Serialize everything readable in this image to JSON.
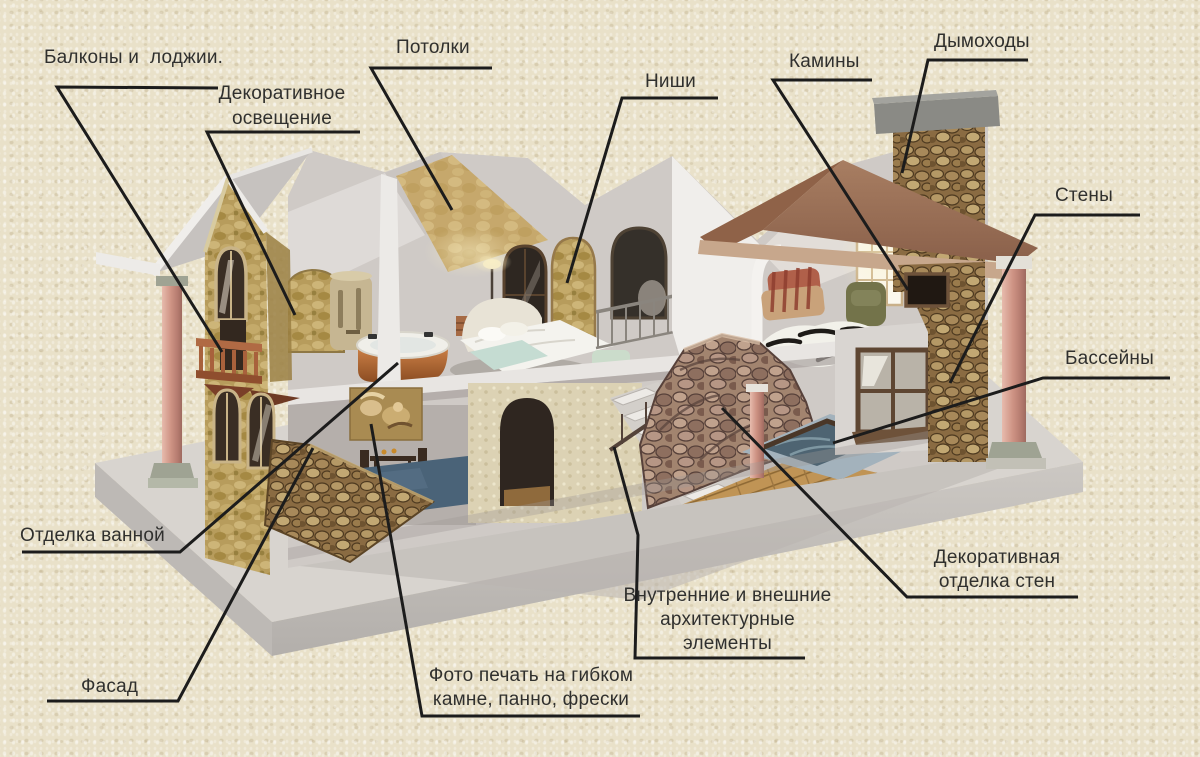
{
  "diagram": {
    "type": "labeled-cutaway-house",
    "language": "ru",
    "subject": "house-finishing-services",
    "labels": {
      "balconies": {
        "text": "Балконы и  лоджии."
      },
      "decorative_lighting": {
        "text": "Декоративное\nосвещение"
      },
      "ceilings": {
        "text": "Потолки"
      },
      "niches": {
        "text": "Ниши"
      },
      "fireplaces": {
        "text": "Камины"
      },
      "chimneys": {
        "text": "Дымоходы"
      },
      "walls": {
        "text": "Стены"
      },
      "pools": {
        "text": "Бассейны"
      },
      "bathroom_finish": {
        "text": "Отделка ванной"
      },
      "facade": {
        "text": "Фасад"
      },
      "photo_print": {
        "text": "Фото печать на гибком\nкамне, панно, фрески"
      },
      "architectural_elements": {
        "text": "Внутренние и внешние\nархитектурные\nэлементы"
      },
      "wall_decor": {
        "text": "Декоративная\nотделка стен"
      }
    },
    "colors": {
      "background": "#E9E1C9",
      "leader_line": "#1C1C1C",
      "label_text": "#30302E",
      "facade_stone": "#B79C5C",
      "rock_stone": "#8A6B42",
      "roof": "#9B7258",
      "pool_water": "#4E6472",
      "column_marble": "#CE9384",
      "platform": "#D8D4CF"
    }
  }
}
